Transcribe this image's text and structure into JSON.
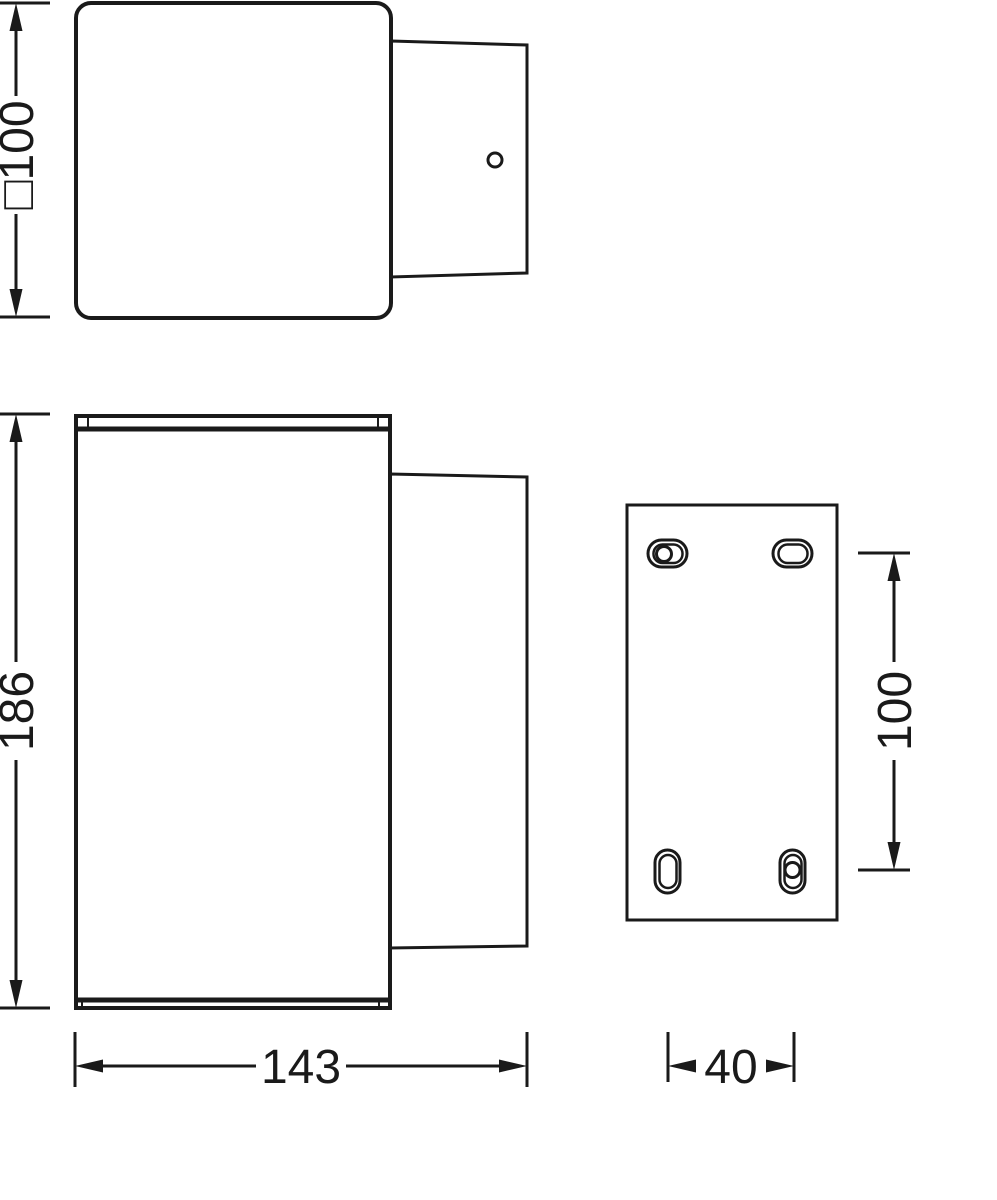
{
  "drawing": {
    "type": "technical-dimension-drawing",
    "views": [
      "top-view",
      "front-view",
      "mounting-plate-view"
    ]
  },
  "dimensions": {
    "top_view_square_width": "□100",
    "front_view_height": "186",
    "front_view_width": "143",
    "plate_hole_spacing": "100",
    "plate_hole_column_spacing": "40"
  },
  "colors": {
    "line": "#1a1a1a",
    "background": "#ffffff"
  }
}
